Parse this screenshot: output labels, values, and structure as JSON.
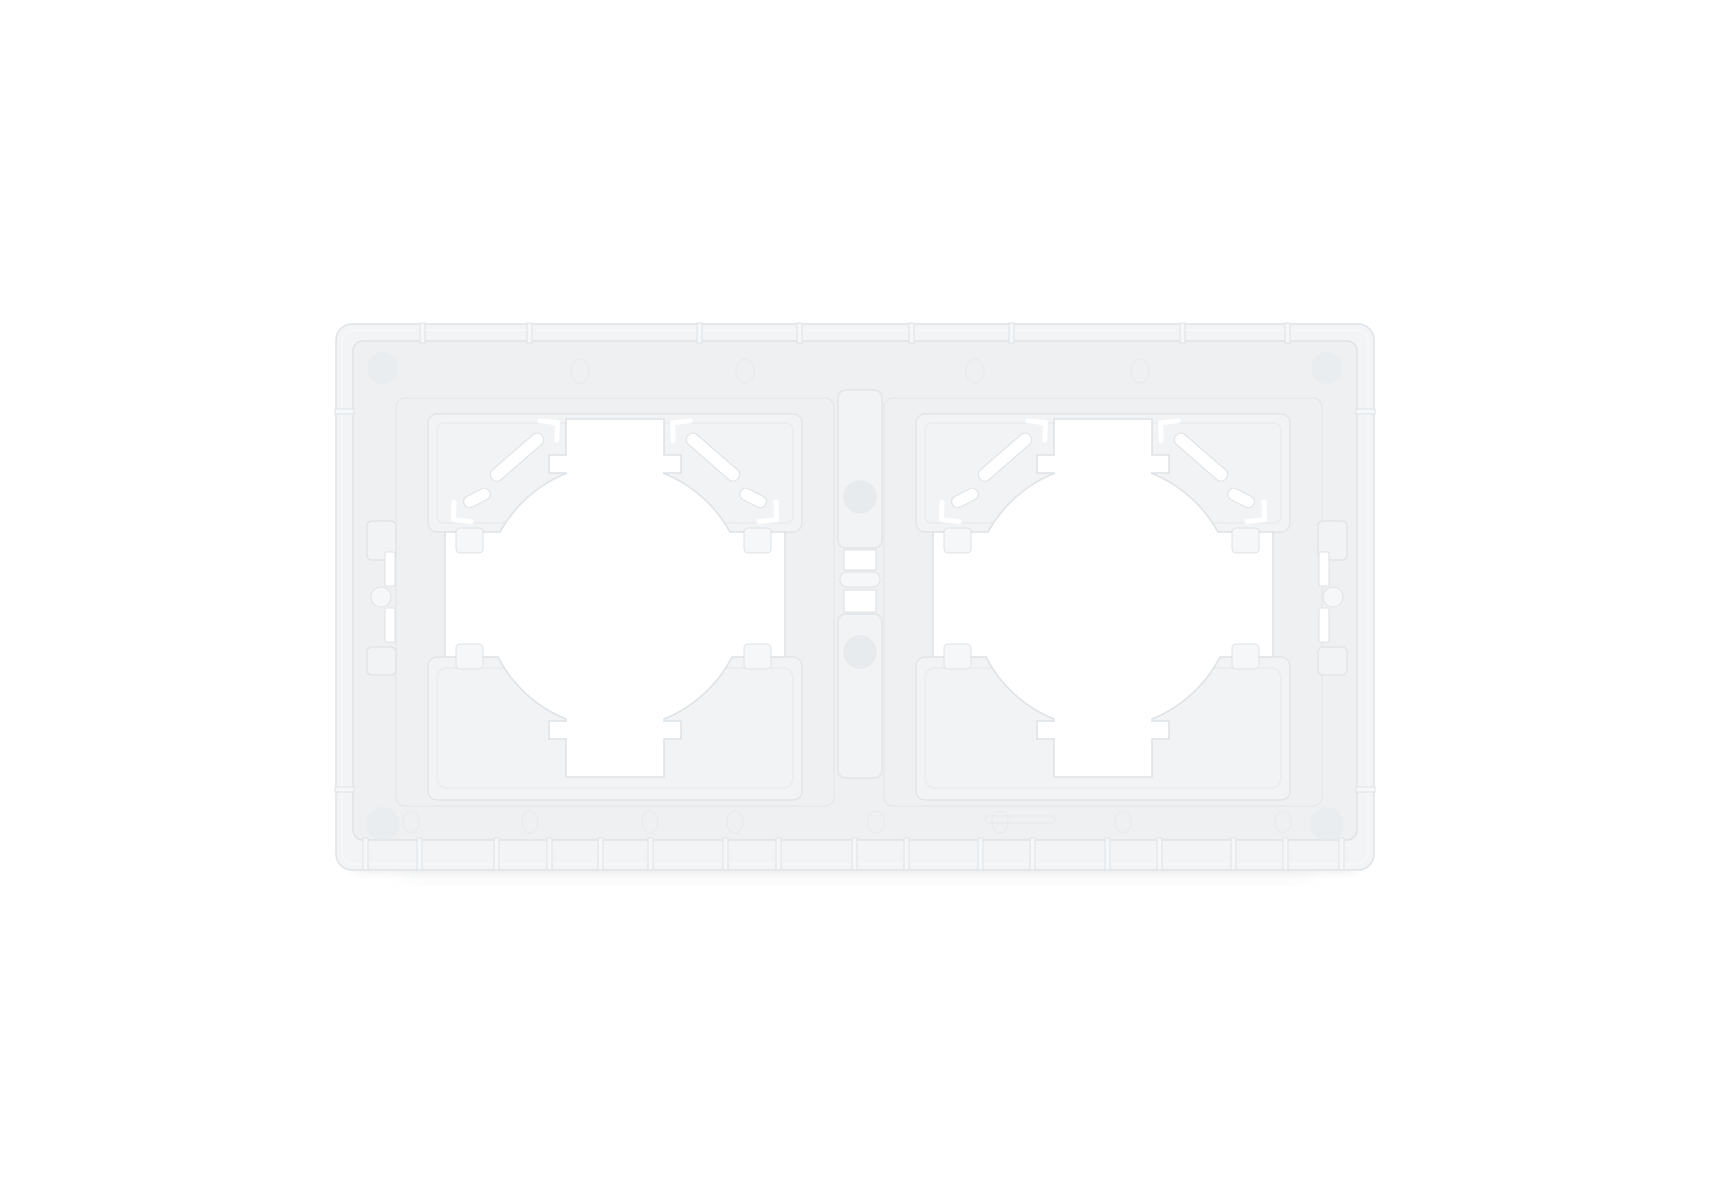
{
  "image": {
    "subject": "Rear view of a white two-gang plastic wall plate frame for round sockets and switches",
    "background": "plain white studio background",
    "modules": [
      "left socket aperture",
      "right socket aperture"
    ]
  },
  "colors": {
    "background": "#ffffff",
    "wall": "#f3f4f6",
    "face": "#eef0f2",
    "flap": "#f2f3f5",
    "raised": "#f6f7f8",
    "edge": "#dfe3e6",
    "groove": "#e5e8ea",
    "mark": "#e8ebed",
    "hole": "#ffffff",
    "shadow": "#c7cacc"
  }
}
